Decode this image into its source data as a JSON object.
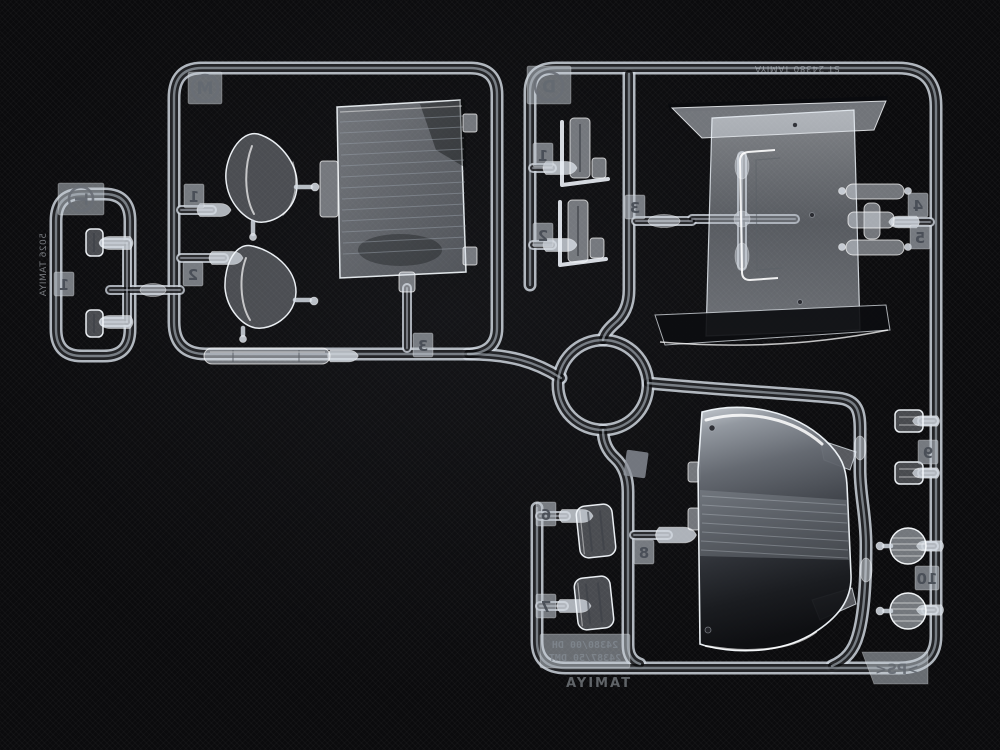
{
  "scene": {
    "subject": "Clear plastic model-kit parts sprues (clear runner) photographed on black fabric",
    "background_color": "#0b0b0d",
    "plastic_tint": "#d9dfe6"
  },
  "badges": {
    "small_sprue": "T",
    "main_sprue": "M",
    "right_sprue": "D"
  },
  "part_tags": {
    "small_1": "1",
    "m_1": "1",
    "m_2": "2",
    "m_3": "3",
    "r_1": "1",
    "r_2": "2",
    "r_3": "3",
    "r_4": "4",
    "r_5": "5",
    "b_6": "6",
    "b_7": "7",
    "b_8": "8",
    "b_9": "9",
    "b_10": "10"
  },
  "moldings": {
    "side_text": "5026 TAMIYA",
    "top_frame_text": "ST 24380 TAMIYA",
    "mold_line1": "24380/00 DH",
    "mold_line2": "24387/50 DMT",
    "brand": "TAMIYA",
    "material_mark": ">PS<"
  }
}
